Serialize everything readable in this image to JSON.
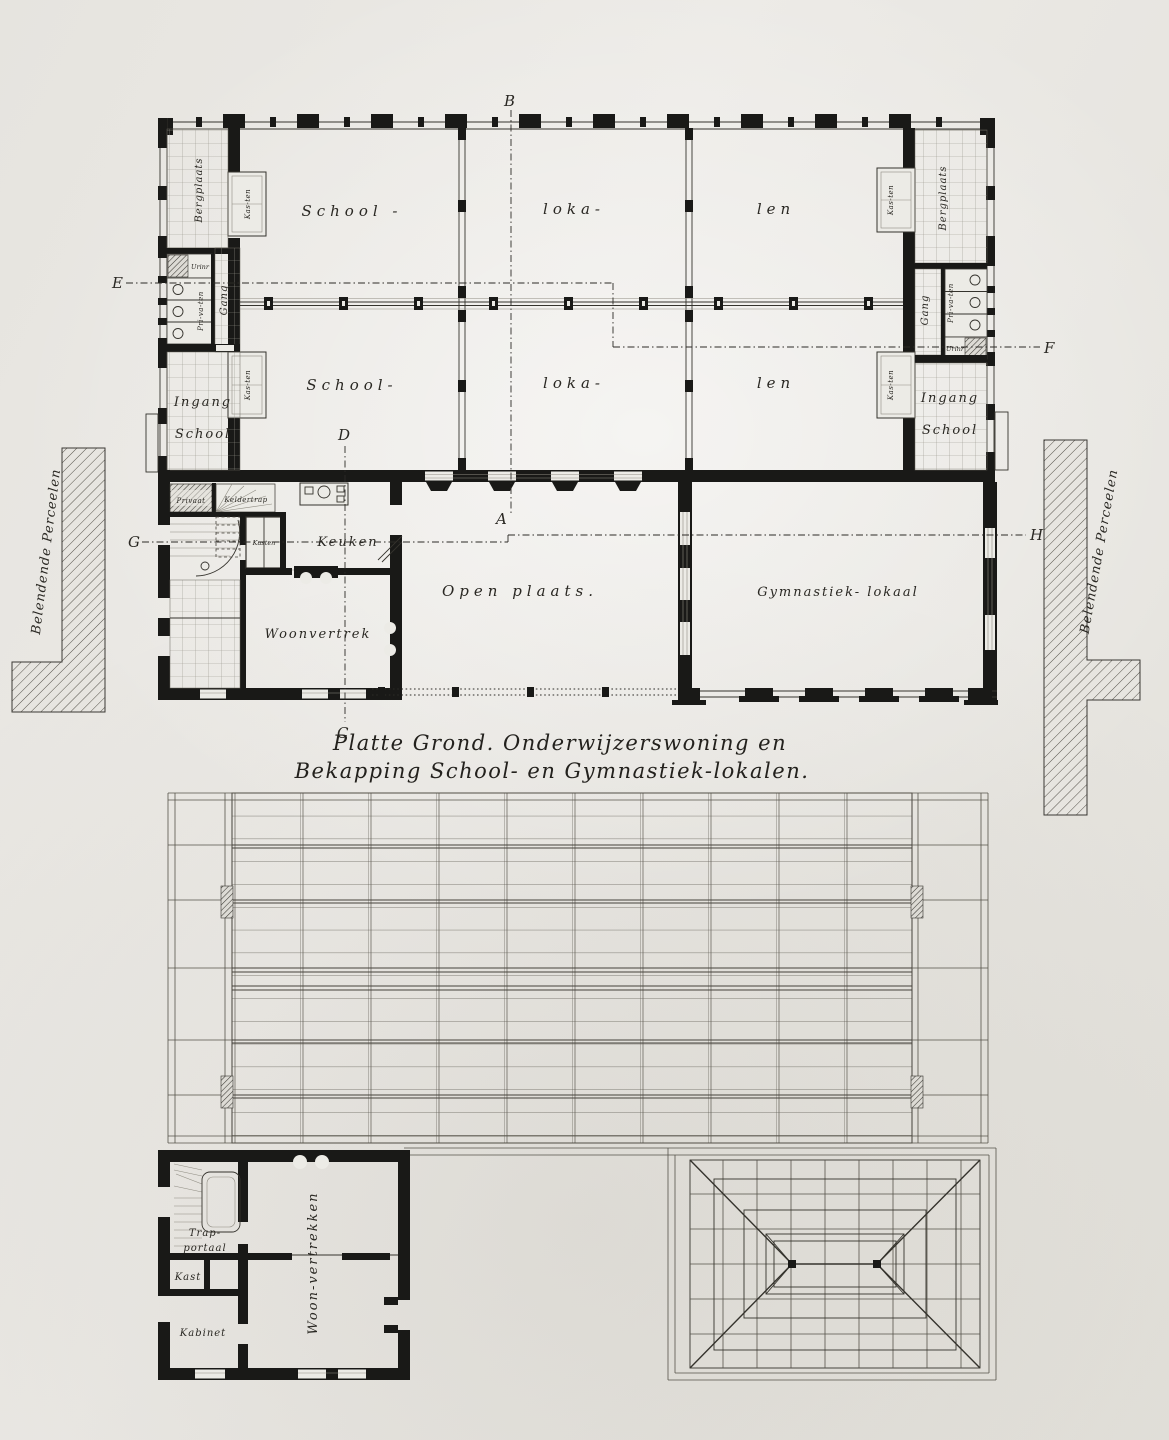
{
  "page": {
    "paper_color": "#e9e7e2",
    "ink_color": "#191917"
  },
  "title": {
    "line1": "Platte Grond. Onderwijzerswoning en",
    "line2": "Bekapping School- en Gymnastiek-lokalen."
  },
  "floor_plan": {
    "classrooms": {
      "r1c1": "School -",
      "r1c2": "loka-",
      "r1c3": "len",
      "r2c1": "School-",
      "r2c2": "loka-",
      "r2c3": "len"
    },
    "left_wing": {
      "bergplaats": "Bergplaats",
      "kasten_top": "Kas-ten",
      "urinoir": "Urinr",
      "privaten": "Pri-va-ten",
      "gang": "Gang",
      "ingang_line1": "Ingang",
      "ingang_line2": "School",
      "kasten_bottom": "Kas-ten"
    },
    "right_wing": {
      "bergplaats": "Bergplaats",
      "kasten_top": "Kas-ten",
      "urinoir": "Urinr",
      "privaten": "Pri-va-ten",
      "gang": "Gang",
      "ingang_line1": "Ingang",
      "ingang_line2": "School",
      "kasten_bottom": "Kas-ten"
    },
    "house": {
      "privaat": "Privaat",
      "keldertrap": "Keldertrap",
      "kasten": "Kasten",
      "keuken": "Keuken",
      "woonvertrek": "Woonvertrek"
    },
    "courtyard": "Open plaats.",
    "gym": "Gymnastiek- lokaal",
    "parcels_left": "Belendende Perceelen",
    "parcels_right": "Belendende Perceelen",
    "sections": {
      "a": "A",
      "b": "B",
      "c": "C",
      "d": "D",
      "e": "E",
      "f": "F",
      "g": "G",
      "h": "H"
    }
  },
  "roof_plan": {
    "trap_line1": "Trap-",
    "trap_line2": "portaal",
    "kast": "Kast",
    "kabinet": "Kabinet",
    "woonvertrekken": "Woon-vertrekken"
  }
}
